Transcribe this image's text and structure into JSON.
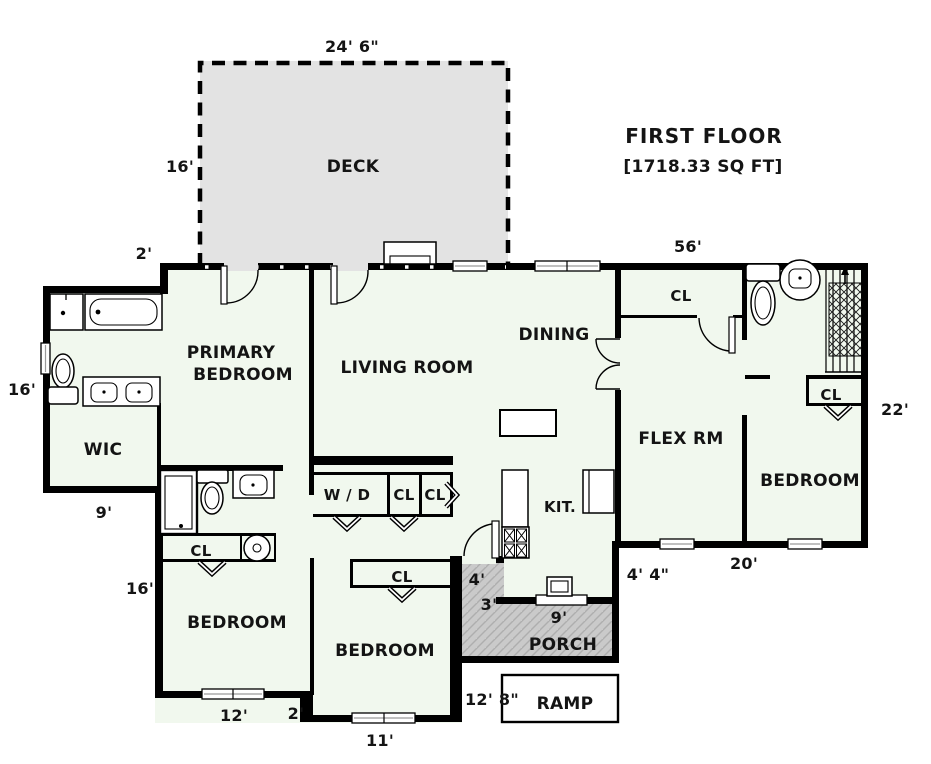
{
  "title": {
    "line1": "FIRST FLOOR",
    "line2": "[1718.33 SQ FT]"
  },
  "rooms": {
    "deck": "DECK",
    "primary_line1": "PRIMARY",
    "primary_line2": "BEDROOM",
    "living": "LIVING ROOM",
    "dining": "DINING",
    "wic": "WIC",
    "flex": "FLEX RM",
    "bedroom_right": "BEDROOM",
    "bedroom_left": "BEDROOM",
    "bedroom_middle": "BEDROOM",
    "kitchen": "KIT.",
    "porch": "PORCH",
    "ramp": "RAMP",
    "laundry": "W / D"
  },
  "closets": {
    "hall": "CL",
    "laundry_1": "CL",
    "laundry_2": "CL",
    "bedroom_middle": "CL",
    "bedroom_left": "CL",
    "under_stairs": "CL"
  },
  "dimensions": {
    "deck_width": "24' 6\"",
    "deck_depth": "16'",
    "front_offset": "2'",
    "top_wall": "56'",
    "bath_wing_depth": "16'",
    "wic_width": "9'",
    "right_wall": "22'",
    "lower_left_depth": "16'",
    "bedroom_left_width": "12'",
    "bedroom_step_offset": "2'",
    "bedroom_middle_width": "11'",
    "ramp_width": "12' 8\"",
    "porch_nook_width": "4'",
    "porch_nook_depth": "3'",
    "porch_width": "9'",
    "entry_side": "4' 4\"",
    "rear_wall": "20'"
  },
  "colors": {
    "wall": "#000000",
    "floor": "#f1f8ee",
    "deck": "#e3e3e3",
    "porch": "#cacaca",
    "background": "#ffffff",
    "text": "#141414"
  }
}
